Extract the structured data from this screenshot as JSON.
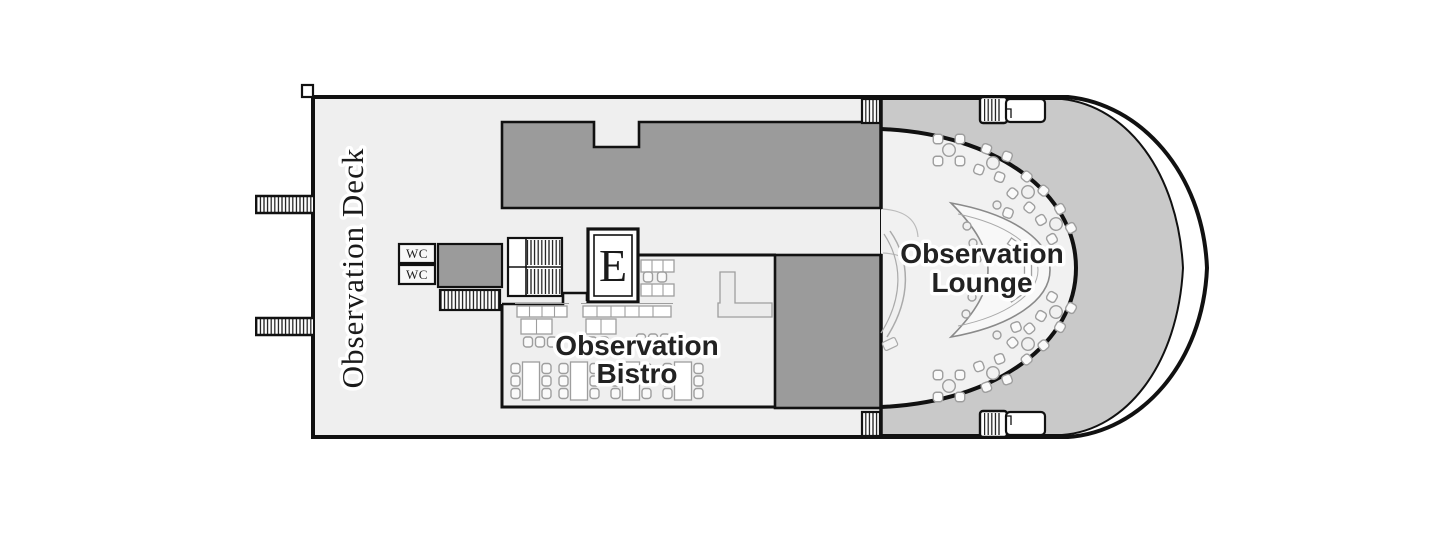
{
  "colors": {
    "wall": "#111111",
    "deck_fill": "#efefef",
    "bow_deck_fill": "#c9c9c9",
    "structure_fill": "#9b9b9b",
    "lounge_fill": "#f1f1f1",
    "room_fill": "#f8f8f8"
  },
  "labels": {
    "deck_name": "Observation Deck",
    "lounge_line1": "Observation",
    "lounge_line2": "Lounge",
    "bistro_line1": "Observation",
    "bistro_line2": "Bistro",
    "wc_upper": "WC",
    "wc_lower": "WC",
    "elevator": "E"
  }
}
